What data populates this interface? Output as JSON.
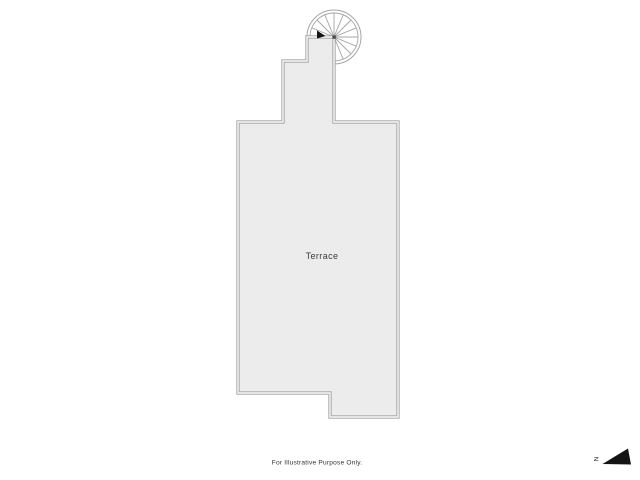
{
  "window": {
    "width": 640,
    "height": 480,
    "background": "#ffffff"
  },
  "floorplan": {
    "room_label": "Terrace",
    "disclaimer": "For Illustrative Purpose Only.",
    "compass": {
      "label": "N"
    },
    "features": {
      "stair": "spiral-staircase"
    },
    "colors": {
      "room_fill": "#ececec",
      "wall_line": "#9e9e9e",
      "wall_gap": "#fbfbfb",
      "stair_line": "#a5a5a5",
      "stair_fill": "#ffffff",
      "label_text": "#3b3b3b",
      "disclaimer_text": "#333333",
      "compass_fill": "#141414"
    }
  }
}
